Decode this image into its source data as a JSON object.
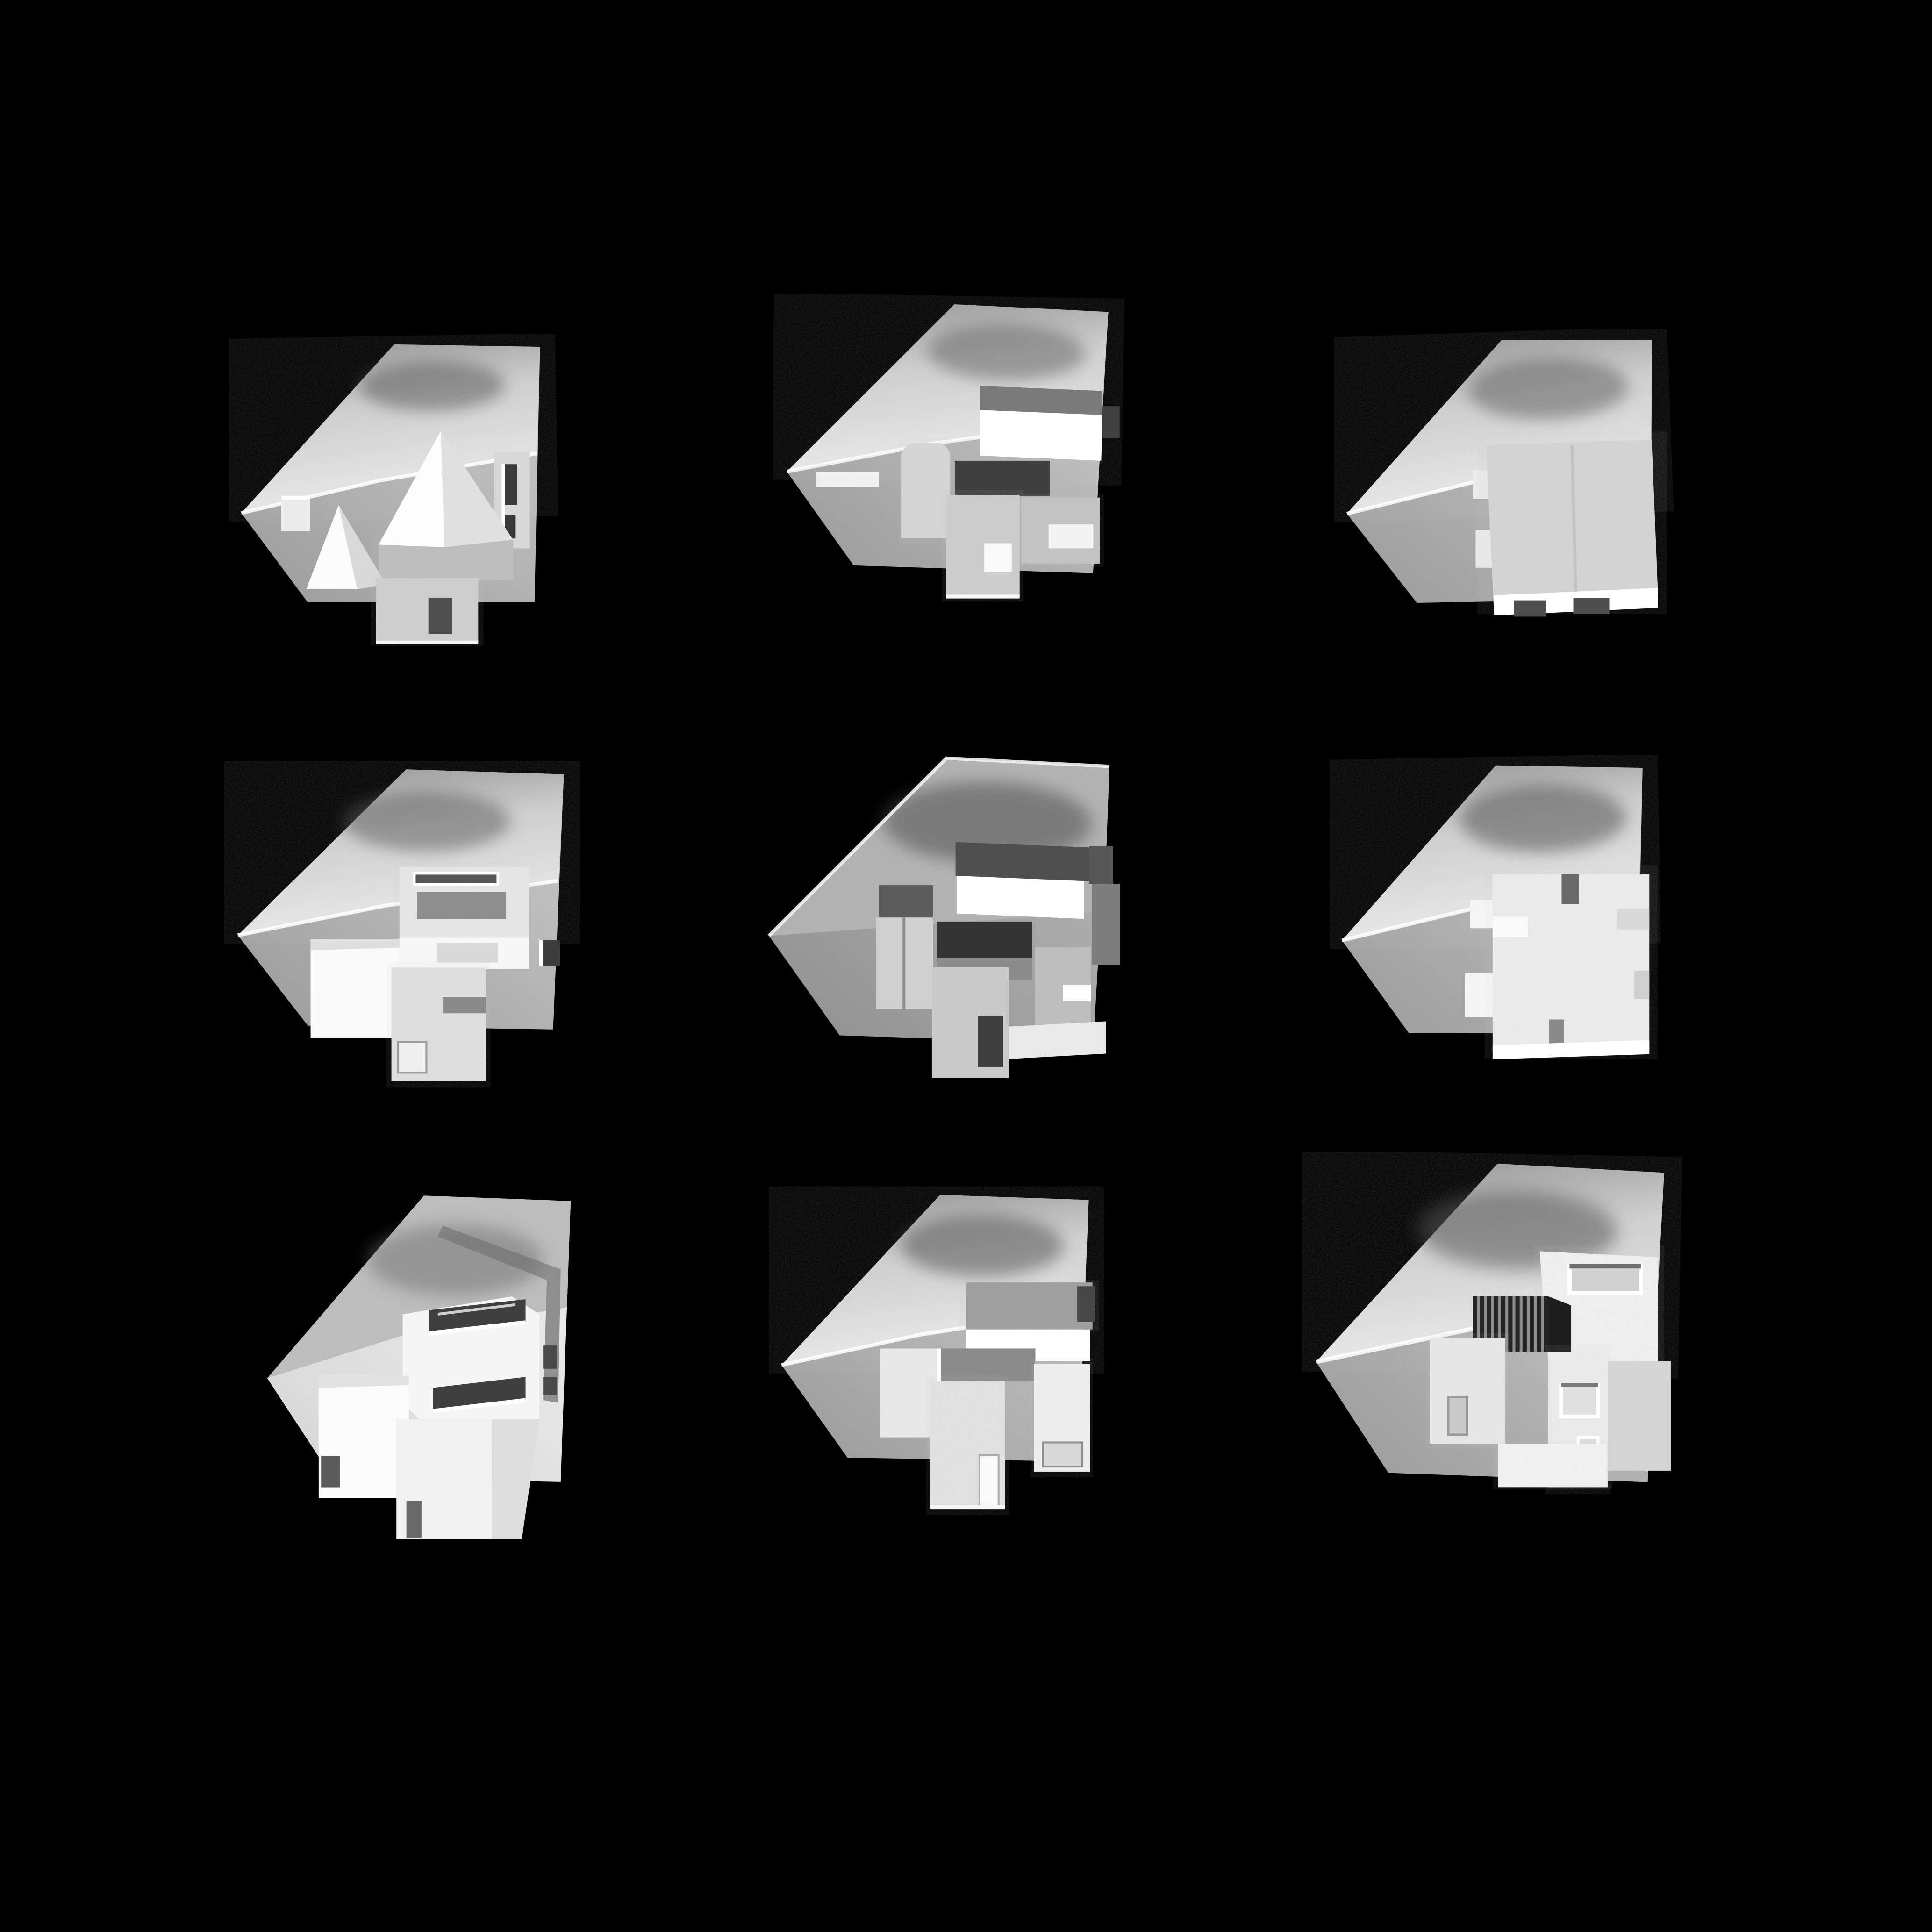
{
  "page": {
    "kind": "photograph",
    "background_color": "#000000",
    "description": "Nine grayscale architectural massing study models of the same corner site, photographed from above on a black background, arranged in a 3x3 grid",
    "visible_text": ""
  },
  "grid": {
    "rows": 3,
    "cols": 3,
    "count": 9
  },
  "palette": {
    "background": "#000000",
    "site_card_light": "#c6c6c6",
    "site_card_dark": "#9a9a9a",
    "slope_highlight": "#e9e9e9",
    "slope_shadow": "#5f5f5f",
    "foam_white": "#f4f4f4",
    "bright_white": "#ffffff",
    "mid_gray": "#bdbdbd",
    "dark_slot": "#3a3a3a",
    "cardboard_gray": "#8f8f8f"
  },
  "models": [
    {
      "row": 1,
      "col": 1,
      "material": "foam and card",
      "description": "Site model with one large and one small pyramidal roof volume, slotted tower at right, low block with dark doorway at front"
    },
    {
      "row": 1,
      "col": 2,
      "material": "foam",
      "description": "Site model of stepped rectangular volumes with one brightly lit bar at top right and a deep dark recess at its center"
    },
    {
      "row": 1,
      "col": 3,
      "material": "foam",
      "description": "Site model with a single large square foam block, notched along its lower edge, set into the sloped site"
    },
    {
      "row": 2,
      "col": 1,
      "material": "foam",
      "description": "Site model with large white slab at left and carved courtyard block with roof slot and small dark doorway at right"
    },
    {
      "row": 2,
      "col": 2,
      "material": "gray card",
      "description": "Cardboard site model of many interlocking rectangular slabs with dark roof planes and a bright white front band"
    },
    {
      "row": 2,
      "col": 3,
      "material": "foam",
      "description": "Site model with a single square foam mass whose edges are cut with slots and tabs, resembling a castle plan"
    },
    {
      "row": 3,
      "col": 1,
      "material": "white paper",
      "description": "White paper model of cubic volumes; the main cube has two dark horizontal ribbon windows, a smaller cube sits at left"
    },
    {
      "row": 3,
      "col": 2,
      "material": "foam",
      "description": "Site model with long bar volume at top lit brightly from below, cube at left and textured blocks with door openings at front"
    },
    {
      "row": 3,
      "col": 3,
      "material": "foam",
      "description": "Site model of clustered foam volumes with a dark corrugated stair element and several punched window openings"
    }
  ]
}
